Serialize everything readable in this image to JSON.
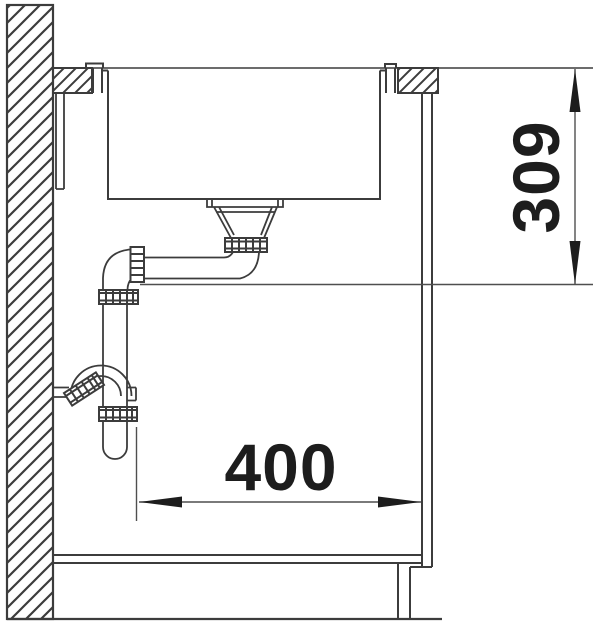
{
  "diagram": {
    "dimension_labels": {
      "depth": "309",
      "width": "400"
    },
    "colors": {
      "background": "#ffffff",
      "line": "#3c3c3c",
      "thin_line": "#4f4f4f",
      "ink": "#1d1d1d"
    }
  }
}
